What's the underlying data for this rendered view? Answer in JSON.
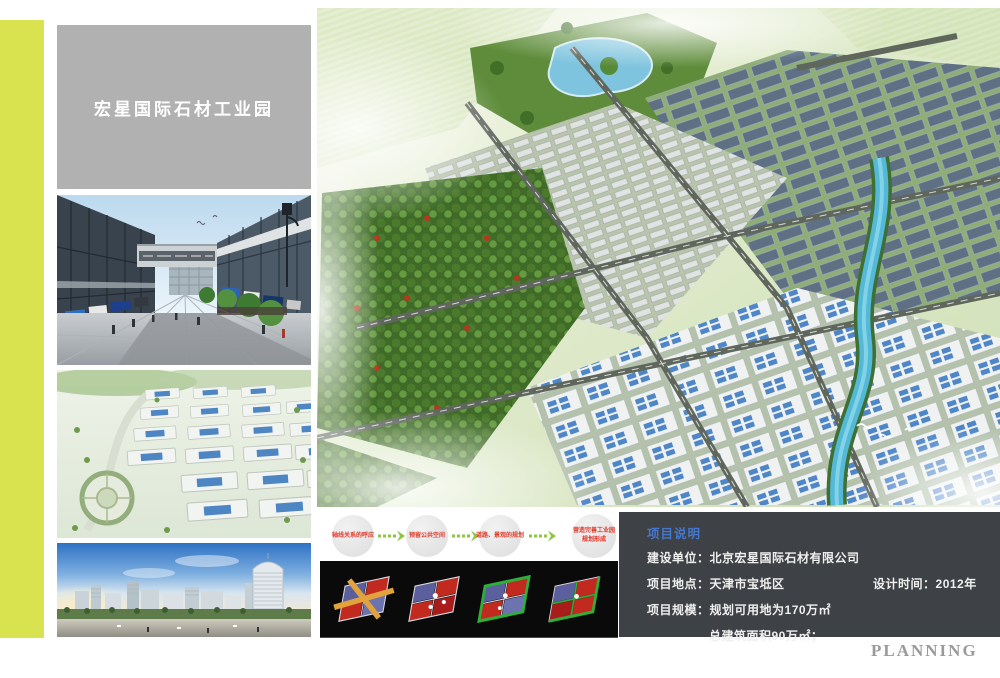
{
  "page": {
    "planning_label": "PLANNING"
  },
  "title_box": {
    "text": "宏星国际石材工业园"
  },
  "flow_steps": [
    {
      "label": "轴线关系的呼应"
    },
    {
      "label": "预留公共空间"
    },
    {
      "label": "道路、景观的规划"
    },
    {
      "label": "营造完善工业园",
      "sublabel": "规划形成"
    }
  ],
  "project_info": {
    "title": "项目说明",
    "row1_label": "建设单位：",
    "row1_value": "北京宏星国际石材有限公司",
    "row2_label": "项目地点：",
    "row2_value": "天津市宝坻区",
    "row2_extra_label": "设计时间：",
    "row2_extra_value": "2012年",
    "row3_label": "项目规模：",
    "row3_value": "规划可用地为170万㎡",
    "row4_value": "总建筑面积90万㎡；"
  },
  "colors": {
    "accent": "#d9e24f",
    "title_box_bg": "#b1b1b1",
    "panel_bg": "#3e4146",
    "panel_title_blue": "#4577cc",
    "flow_text_red": "#e03a2a",
    "arrow_green": "#8dc63f",
    "diagram_panel_bg": "#0a0a0a",
    "planning_gray": "#9a9a9a"
  }
}
